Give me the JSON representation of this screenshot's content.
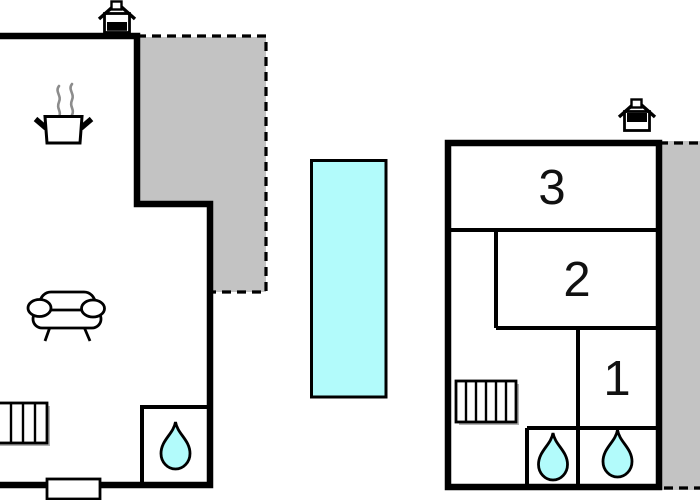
{
  "plan": {
    "type": "holiday-home-floor-plan",
    "buildings": 2
  },
  "rooms": {
    "room3": "3",
    "room2": "2",
    "room1": "1"
  },
  "colors": {
    "wall": "#000000",
    "terrace_fill": "#c3c3c3",
    "water_fill": "#b2fbfb",
    "steam": "#8c8c8c",
    "radiator_shadow": "#b2b2b2"
  },
  "icons": {
    "house_left": "house-orientation-icon",
    "house_right": "house-orientation-icon",
    "cooking": "cooking-pot-icon",
    "sofa": "sofa-icon",
    "radiator_left": "radiator-icon",
    "radiator_right": "radiator-icon",
    "bathroom_drops": "water-drop-icon",
    "pool": "swimming-pool",
    "terraces": "terrace-dashed-area"
  }
}
